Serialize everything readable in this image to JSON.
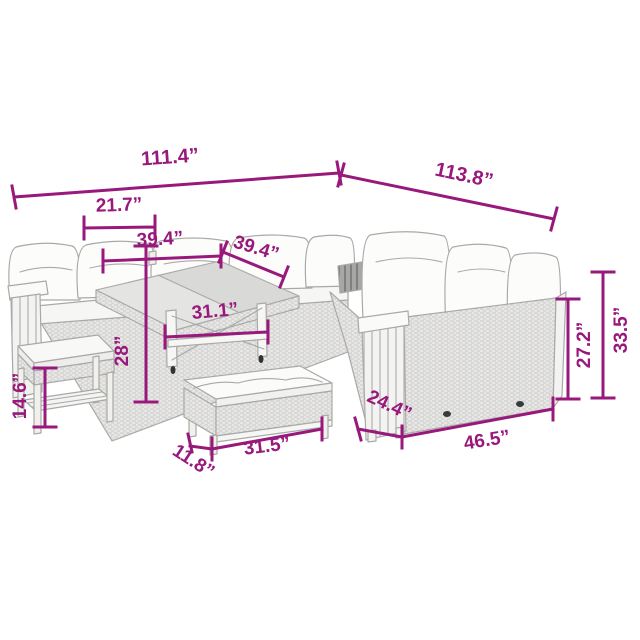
{
  "diagram": {
    "kind": "product-dimension-diagram",
    "subject": "rattan-garden-lounge-set-with-table-and-benches"
  },
  "colors": {
    "accent": "#98187c",
    "sketch": "#a9a9a7",
    "cushion": "#fbfbf9",
    "wicker": "#e8e7e5"
  },
  "dims": {
    "overall_width_front": {
      "value": "111.4”"
    },
    "overall_width_side": {
      "value": "113.8”"
    },
    "back_cushion_width": {
      "value": "21.7”"
    },
    "left_section_width": {
      "value": "39.4”"
    },
    "corner_section_width": {
      "value": "39.4”"
    },
    "table_length": {
      "value": "31.1”"
    },
    "table_height": {
      "value": "28”"
    },
    "footstool_height": {
      "value": "14.6”"
    },
    "bench_depth": {
      "value": "11.8”"
    },
    "bench_length": {
      "value": "31.5”"
    },
    "sofa_depth": {
      "value": "24.4”"
    },
    "sofa_section_length": {
      "value": "46.5”"
    },
    "seat_back_height": {
      "value": "27.2”"
    },
    "total_height": {
      "value": "33.5”"
    }
  }
}
